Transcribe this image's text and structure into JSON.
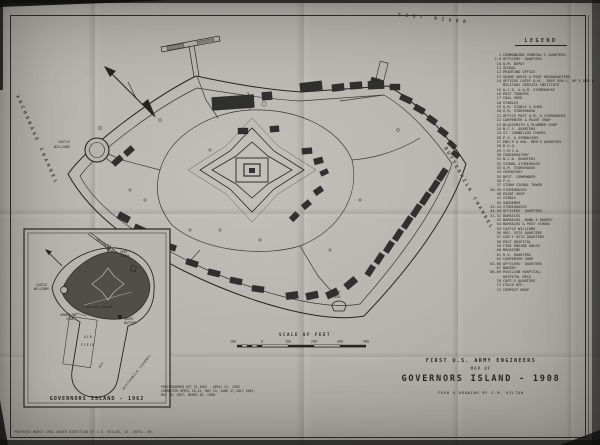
{
  "title": {
    "line1": "FIRST U.S. ARMY ENGINEERS",
    "line2": "MAP OF",
    "line3": "GOVERNORS ISLAND - 1908",
    "credit": "FROM A DRAWING BY J.M. HILTON"
  },
  "legend": {
    "header": "LEGEND",
    "items": [
      {
        "n": "1",
        "label": "COMMANDING GENERAL'S QUARTERS"
      },
      {
        "n": "2-9",
        "label": "OFFICERS' QUARTERS"
      },
      {
        "n": "10",
        "label": "Q.M. DEPOT"
      },
      {
        "n": "11",
        "label": "SCHOOL"
      },
      {
        "n": "12",
        "label": "PRINTING OFFICE"
      },
      {
        "n": "13",
        "label": "GUARD HOUSE & POST HEADQUARTERS"
      },
      {
        "n": "14",
        "label": "OFFICES CHIEF Q.M., INSP GEN'L, NF'S DIR &",
        "label2": "MILITARY SERVICE INSTITUTE"
      },
      {
        "n": "15",
        "label": "A.C.S. & Q.M. STOREHOUSE"
      },
      {
        "n": "16",
        "label": "POST TRADERS"
      },
      {
        "n": "17",
        "label": "COAL SHED"
      },
      {
        "n": "18",
        "label": "STABLES"
      },
      {
        "n": "19",
        "label": "Q.M. STABLE & SHED"
      },
      {
        "n": "20",
        "label": "Q.M. STOREHOUSE"
      },
      {
        "n": "21",
        "label": "OFFICE POST Q.M. & STOREHOUSE"
      },
      {
        "n": "22",
        "label": "CARPENTER & PAINT SHOP"
      },
      {
        "n": "23",
        "label": "BLACKSMITH & PLUMBER SHOP"
      },
      {
        "n": "24",
        "label": "N.C.S. QUARTERS"
      },
      {
        "n": "25",
        "label": "ST. CORNELIUS CHAPEL"
      },
      {
        "n": "26",
        "label": "P.X. & GYMNASIUM"
      },
      {
        "n": "27",
        "label": "ENG'R & ENL. MEN'S QUARTERS"
      },
      {
        "n": "28",
        "label": "B.O.Q."
      },
      {
        "n": "29",
        "label": "Y.M.C.A."
      },
      {
        "n": "30",
        "label": "CONSERVATORY"
      },
      {
        "n": "31",
        "label": "N.C.O. QUARTERS"
      },
      {
        "n": "32",
        "label": "SIGNAL STOREHOUSE"
      },
      {
        "n": "33",
        "label": "Q.M. STOREHOUSE"
      },
      {
        "n": "34",
        "label": "CREMATORY"
      },
      {
        "n": "35",
        "label": "DEPT. COMMANDER"
      },
      {
        "n": "36",
        "label": "P.O."
      },
      {
        "n": "37",
        "label": "STORM SIGNAL TOWER"
      },
      {
        "n": "38-39",
        "label": "STOREHOUSES"
      },
      {
        "n": "40",
        "label": "PAINT SHOP"
      },
      {
        "n": "41",
        "label": "STABLE"
      },
      {
        "n": "42",
        "label": "GARDENER"
      },
      {
        "n": "43-44",
        "label": "STOREHOUSES"
      },
      {
        "n": "45-50",
        "label": "OFFICERS' QUARTERS"
      },
      {
        "n": "51-52",
        "label": "BARRACKS"
      },
      {
        "n": "53",
        "label": "BARRACKS, BAND & BAKERY"
      },
      {
        "n": "54",
        "label": "BARRACKS & POST SCHOOL"
      },
      {
        "n": "55",
        "label": "CASTLE WILLIAMS"
      },
      {
        "n": "56",
        "label": "ORD. SGTS QUARTERS"
      },
      {
        "n": "57",
        "label": "COM'Y SGTS QUARTERS"
      },
      {
        "n": "58",
        "label": "POST HOSPITAL"
      },
      {
        "n": "59",
        "label": "FIRE ENGINE HOUSE"
      },
      {
        "n": "60",
        "label": "MAGAZINE"
      },
      {
        "n": "61",
        "label": "H.S. QUARTERS"
      },
      {
        "n": "62",
        "label": "CARPENTER SHOP"
      },
      {
        "n": "63-66",
        "label": "OFFICERS' QUARTERS"
      },
      {
        "n": "67",
        "label": "BAKERY"
      },
      {
        "n": "68-69",
        "label": "PAVILION HOSPITAL,",
        "label2": "HOSPITAL MESS"
      },
      {
        "n": "70",
        "label": "CAPT'S QUARTERS"
      },
      {
        "n": "71",
        "label": "FIELD OFF."
      },
      {
        "n": "72",
        "label": "COMPOST HEAP"
      }
    ]
  },
  "scale": {
    "caption": "SCALE OF FEET",
    "ticks": [
      "100",
      "0",
      "100",
      "200",
      "300",
      "400"
    ]
  },
  "notes": {
    "photo_lines": [
      "PHOTOGRAPHED OCT 31,1962 - APRIL 22, 1963",
      "CORRECTED APRIL 18,24, MAY 23, JUNE 27,JULY 1963,",
      "MAY 10, 1967, MARCH 16, 1968."
    ],
    "prepared": "PREPARED MARCH 1962 UNDER DIRECTION OF C.O. KEELER, CO. INTEL. BR."
  },
  "map": {
    "labels": {
      "east_river": "EAST RIVER",
      "buttermilk_channel": "BUTTERMILK CHANNEL",
      "anchorage_channel": "ANCHORAGE CHANNEL",
      "castle_l1": "CASTLE",
      "castle_l2": "WILLIAMS",
      "battery_l1": "SOUTH",
      "battery_l2": "BATTERY"
    }
  },
  "inset": {
    "caption": "GOVERNORS ISLAND - 1962",
    "labels": {
      "castle_l1": "CASTLE",
      "castle_l2": "WILLIAMS",
      "vent_l1": "VENT",
      "vent_l2": "TOWER",
      "tunnel": "BROOKLYN BATTERY TUNNEL",
      "shoreline_l1": "SHORELINE",
      "shoreline_l2": "1908",
      "original_island": "ORIGINAL ISLAND",
      "battery_l1": "SOUTH",
      "battery_l2": "BATTERY",
      "air_l1": "AIR",
      "air_l2": "FIELD",
      "dock": "DOCK",
      "buttermilk": "BUTTERMILK CHANNEL"
    }
  },
  "colors": {
    "paper": "#b5b3ae",
    "ink": "#26261f",
    "building": "#30302e",
    "inset_shade": "#504e49"
  }
}
